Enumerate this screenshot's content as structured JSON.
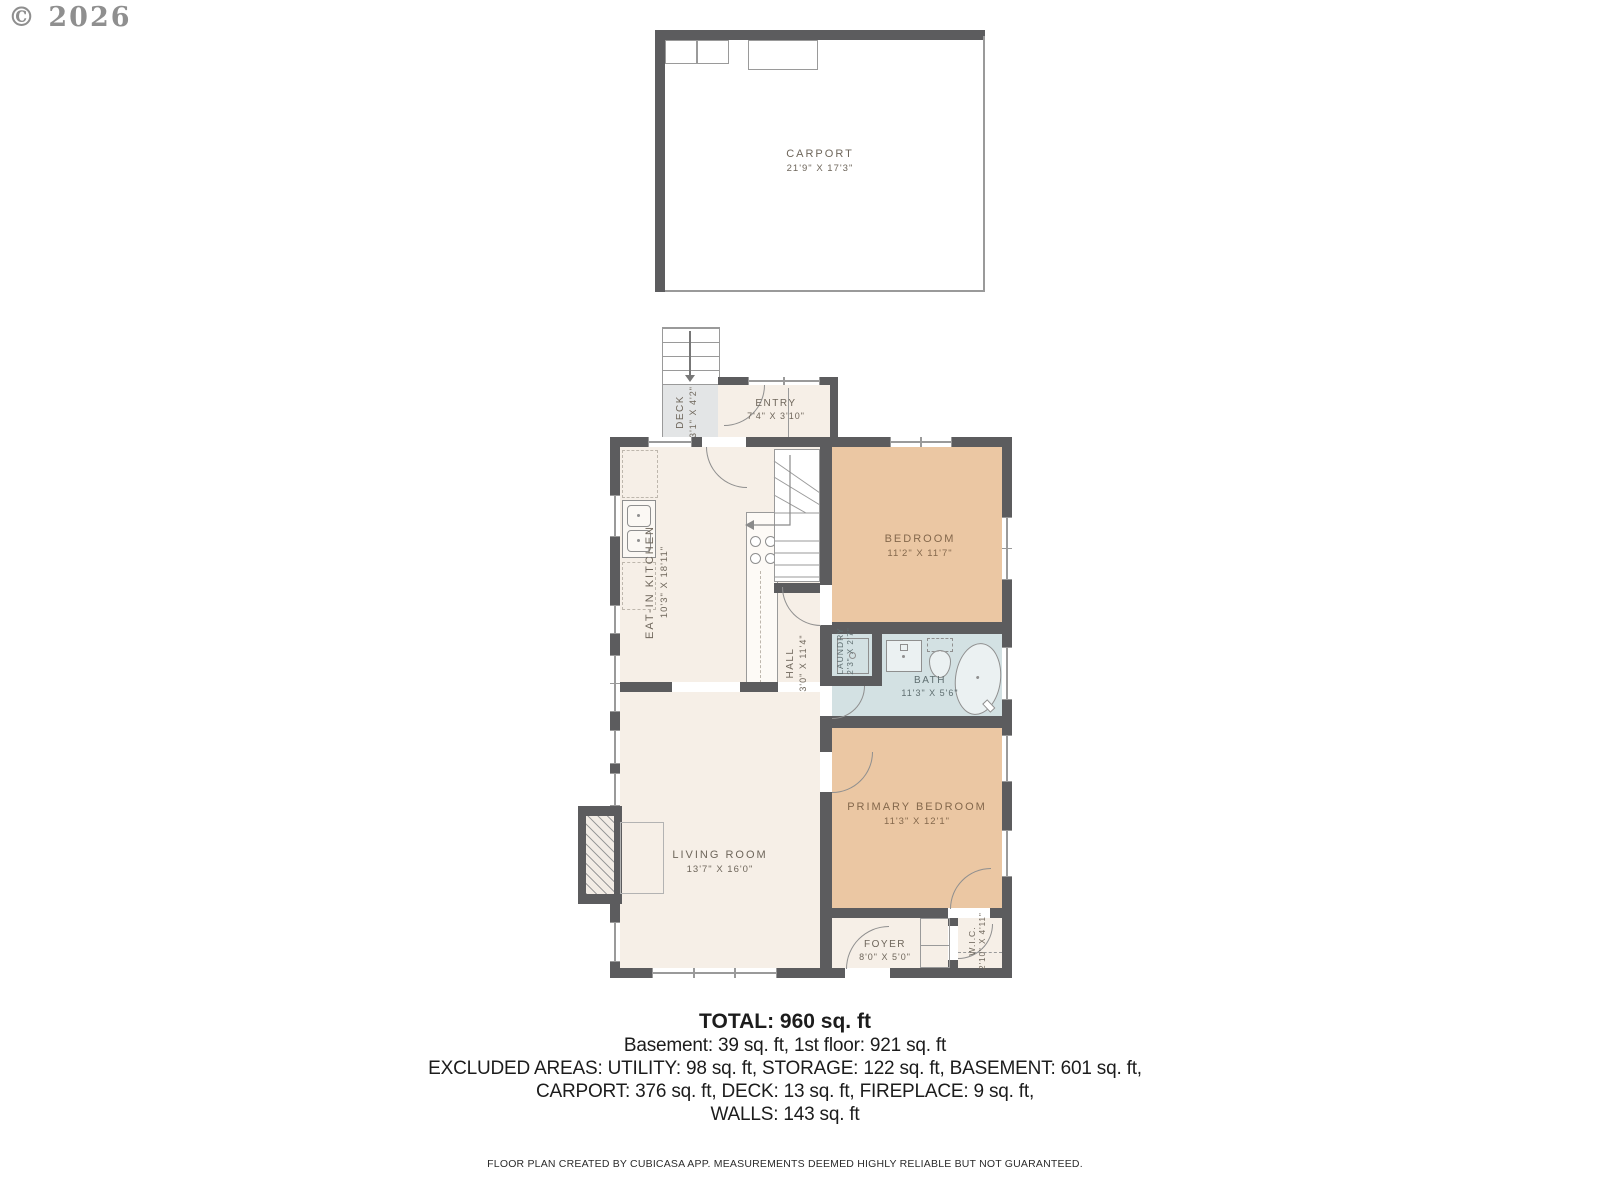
{
  "watermark": "© 2026",
  "rooms": {
    "carport": {
      "name": "CARPORT",
      "dims": "21'9\" x 17'3\""
    },
    "deck": {
      "name": "DECK",
      "dims": "3'1\" x 4'2\""
    },
    "entry": {
      "name": "ENTRY",
      "dims": "7'4\" x 3'10\""
    },
    "kitchen": {
      "name": "EAT-IN KITCHEN",
      "dims": "10'3\" x 18'11\""
    },
    "bedroom": {
      "name": "BEDROOM",
      "dims": "11'2\" x 11'7\""
    },
    "hall": {
      "name": "HALL",
      "dims": "3'0\" x 11'4\""
    },
    "laundry": {
      "name": "LAUNDRY",
      "dims": "2'3\" x 2'7\""
    },
    "bath": {
      "name": "BATH",
      "dims": "11'3\" x 5'6\""
    },
    "primary_bedroom": {
      "name": "PRIMARY BEDROOM",
      "dims": "11'3\" x 12'1\""
    },
    "living_room": {
      "name": "LIVING ROOM",
      "dims": "13'7\" x 16'0\""
    },
    "foyer": {
      "name": "FOYER",
      "dims": "8'0\" x 5'0\""
    },
    "wic": {
      "name": "W.I.C.",
      "dims": "2'10\" x 4'11\""
    }
  },
  "summary": {
    "total": "TOTAL: 960 sq. ft",
    "line1": "Basement: 39 sq. ft, 1st floor: 921 sq. ft",
    "line2": "EXCLUDED AREAS: UTILITY: 98 sq. ft, STORAGE: 122 sq. ft, BASEMENT: 601 sq. ft,",
    "line3": "CARPORT: 376 sq. ft, DECK: 13 sq. ft, FIREPLACE: 9 sq. ft,",
    "line4": "WALLS: 143 sq. ft"
  },
  "footer": "FLOOR PLAN CREATED BY CUBICASA APP. MEASUREMENTS DEEMED HIGHLY RELIABLE BUT NOT GUARANTEED.",
  "colors": {
    "wall": "#5c5c5e",
    "line": "#9a9a9a",
    "cream": "#f6efe7",
    "tan": "#ebc7a3",
    "blue": "#d3e1e3",
    "deck": "#e3e5e6",
    "label": "#6e665b",
    "labelTan": "#84684c",
    "labelBath": "#5f6e70",
    "text": "#1c1c1c"
  }
}
